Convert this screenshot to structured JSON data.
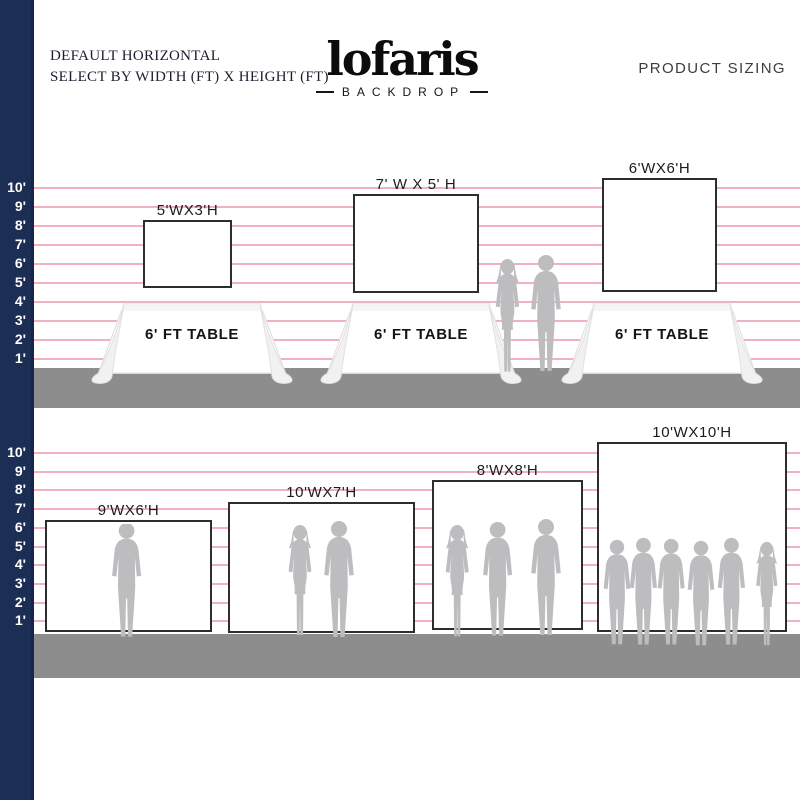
{
  "header": {
    "note_line1": "DEFAULT HORIZONTAL",
    "note_line2": "SELECT BY WIDTH (FT) X HEIGHT (FT)",
    "product_sizing": "PRODUCT SIZING"
  },
  "brand": {
    "name": "lofaris",
    "tagline": "BACKDROP"
  },
  "scale_feet": [
    "10'",
    "9'",
    "8'",
    "7'",
    "6'",
    "5'",
    "4'",
    "3'",
    "2'",
    "1'"
  ],
  "row_table_backdrops": {
    "items": [
      {
        "size": "5'WX3'H",
        "table": "6' FT TABLE"
      },
      {
        "size": "7' W X 5' H",
        "table": "6' FT TABLE"
      },
      {
        "size": "6'WX6'H",
        "table": "6' FT TABLE"
      }
    ]
  },
  "row_standing_backdrops": {
    "items": [
      {
        "size": "9'WX6'H"
      },
      {
        "size": "10'WX7'H"
      },
      {
        "size": "8'WX8'H"
      },
      {
        "size": "10'WX10'H"
      }
    ]
  },
  "colors": {
    "navy": "#1d2e55",
    "pink": "#ef9dac",
    "floor": "#8d8d8d",
    "silhouette": "#bdbdc0"
  }
}
